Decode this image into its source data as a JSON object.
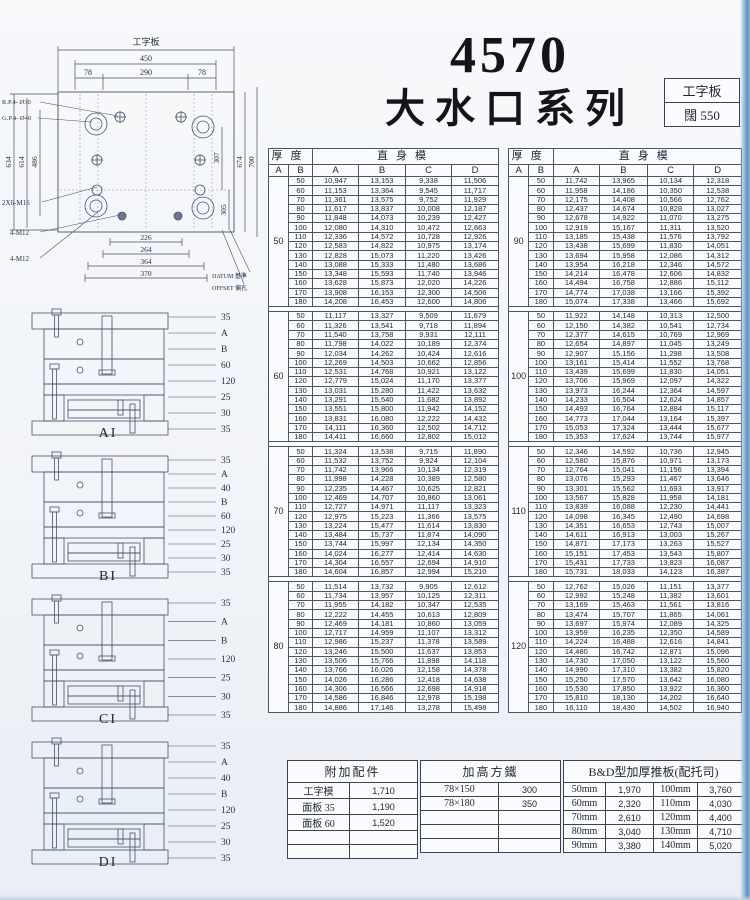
{
  "page": {
    "title": "4570",
    "subtitle": "大水口系列"
  },
  "spec_box": {
    "line1": "工字板",
    "line2_label": "闊",
    "line2_value": "550"
  },
  "drawing": {
    "plate_label": "工字板",
    "dim_450": "450",
    "dim_78l": "78",
    "dim_290": "290",
    "dim_78r": "78",
    "rp": "R.P.4- Ø30",
    "gp": "G.P.4- Ø40",
    "dim_634": "634",
    "dim_614": "614",
    "dim_486": "486",
    "dim_307": "307",
    "dim_305": "305",
    "dim_674": "674",
    "dim_700": "700",
    "m16": "2X6-M16",
    "m12a": "4-M12",
    "m12b": "4-M12",
    "dim_226": "226",
    "dim_264": "264",
    "dim_364": "364",
    "dim_370": "370",
    "datum": "DATUM 基準",
    "offset": "OFFSET 偏孔"
  },
  "diagrams": [
    {
      "label": "AI",
      "dims": [
        "35",
        "A",
        "B",
        "60",
        "120",
        "25",
        "30",
        "35"
      ]
    },
    {
      "label": "BI",
      "dims": [
        "35",
        "A",
        "40",
        "B",
        "60",
        "120",
        "25",
        "30",
        "35"
      ]
    },
    {
      "label": "CI",
      "dims": [
        "35",
        "A",
        "B",
        "120",
        "25",
        "30",
        "35"
      ]
    },
    {
      "label": "DI",
      "dims": [
        "35",
        "A",
        "40",
        "B",
        "120",
        "25",
        "30",
        "35"
      ]
    }
  ],
  "table_header": {
    "thickness": "厚度",
    "straight": "直身模",
    "col_a": "A",
    "col_b": "B",
    "subcols": [
      "A",
      "B",
      "C",
      "D"
    ]
  },
  "left_table": {
    "blocks": [
      {
        "a": "50",
        "rows": [
          [
            "50",
            "10,947",
            "13,153",
            "9,338",
            "11,506"
          ],
          [
            "60",
            "11,153",
            "13,364",
            "9,545",
            "11,717"
          ],
          [
            "70",
            "11,361",
            "13,575",
            "9,752",
            "11,929"
          ],
          [
            "80",
            "11,617",
            "13,837",
            "10,008",
            "12,187"
          ],
          [
            "90",
            "11,848",
            "14,073",
            "10,239",
            "12,427"
          ],
          [
            "100",
            "12,080",
            "14,310",
            "10,472",
            "12,663"
          ],
          [
            "110",
            "12,336",
            "14,572",
            "10,728",
            "12,926"
          ],
          [
            "120",
            "12,583",
            "14,822",
            "10,975",
            "13,174"
          ],
          [
            "130",
            "12,828",
            "15,073",
            "11,220",
            "13,426"
          ],
          [
            "140",
            "13,088",
            "15,333",
            "11,480",
            "13,686"
          ],
          [
            "150",
            "13,348",
            "15,593",
            "11,740",
            "13,946"
          ],
          [
            "160",
            "13,628",
            "15,873",
            "12,020",
            "14,226"
          ],
          [
            "170",
            "13,908",
            "16,153",
            "12,300",
            "14,506"
          ],
          [
            "180",
            "14,208",
            "16,453",
            "12,600",
            "14,806"
          ]
        ]
      },
      {
        "a": "60",
        "rows": [
          [
            "50",
            "11,117",
            "13,327",
            "9,509",
            "11,679"
          ],
          [
            "60",
            "11,326",
            "13,541",
            "9,718",
            "11,894"
          ],
          [
            "70",
            "11,540",
            "13,758",
            "9,931",
            "12,111"
          ],
          [
            "80",
            "11,798",
            "14,022",
            "10,189",
            "12,374"
          ],
          [
            "90",
            "12,034",
            "14,262",
            "10,424",
            "12,616"
          ],
          [
            "100",
            "12,269",
            "14,503",
            "10,662",
            "12,856"
          ],
          [
            "110",
            "12,531",
            "14,768",
            "10,921",
            "13,122"
          ],
          [
            "120",
            "12,779",
            "15,024",
            "11,170",
            "13,377"
          ],
          [
            "130",
            "13,031",
            "15,280",
            "11,422",
            "13,632"
          ],
          [
            "140",
            "13,291",
            "15,540",
            "11,682",
            "13,892"
          ],
          [
            "150",
            "13,551",
            "15,800",
            "11,942",
            "14,152"
          ],
          [
            "160",
            "13,831",
            "16,080",
            "12,222",
            "14,432"
          ],
          [
            "170",
            "14,111",
            "16,360",
            "12,502",
            "14,712"
          ],
          [
            "180",
            "14,411",
            "16,660",
            "12,802",
            "15,012"
          ]
        ]
      },
      {
        "a": "70",
        "rows": [
          [
            "50",
            "11,324",
            "13,538",
            "9,715",
            "11,890"
          ],
          [
            "60",
            "11,532",
            "13,752",
            "9,924",
            "12,104"
          ],
          [
            "70",
            "11,742",
            "13,966",
            "10,134",
            "12,319"
          ],
          [
            "80",
            "11,998",
            "14,228",
            "10,389",
            "12,580"
          ],
          [
            "90",
            "12,235",
            "14,467",
            "10,625",
            "12,821"
          ],
          [
            "100",
            "12,469",
            "14,707",
            "10,860",
            "13,061"
          ],
          [
            "110",
            "12,727",
            "14,971",
            "11,117",
            "13,323"
          ],
          [
            "120",
            "12,975",
            "15,223",
            "11,366",
            "13,575"
          ],
          [
            "130",
            "13,224",
            "15,477",
            "11,614",
            "13,830"
          ],
          [
            "140",
            "13,484",
            "15,737",
            "11,874",
            "14,090"
          ],
          [
            "150",
            "13,744",
            "15,997",
            "12,134",
            "14,350"
          ],
          [
            "160",
            "14,024",
            "16,277",
            "12,414",
            "14,630"
          ],
          [
            "170",
            "14,304",
            "16,557",
            "12,694",
            "14,910"
          ],
          [
            "180",
            "14,604",
            "16,857",
            "12,994",
            "15,210"
          ]
        ]
      },
      {
        "a": "80",
        "rows": [
          [
            "50",
            "11,514",
            "13,732",
            "9,905",
            "12,612"
          ],
          [
            "60",
            "11,734",
            "13,957",
            "10,125",
            "12,311"
          ],
          [
            "70",
            "11,955",
            "14,182",
            "10,347",
            "12,535"
          ],
          [
            "80",
            "12,222",
            "14,455",
            "10,613",
            "12,809"
          ],
          [
            "90",
            "12,469",
            "14,181",
            "10,860",
            "13,059"
          ],
          [
            "100",
            "12,717",
            "14,959",
            "11,107",
            "13,312"
          ],
          [
            "110",
            "12,986",
            "15,237",
            "11,378",
            "13,589"
          ],
          [
            "120",
            "13,246",
            "15,500",
            "11,637",
            "13,853"
          ],
          [
            "130",
            "13,506",
            "15,766",
            "11,898",
            "14,118"
          ],
          [
            "140",
            "13,766",
            "16,026",
            "12,158",
            "14,378"
          ],
          [
            "150",
            "14,026",
            "16,286",
            "12,418",
            "14,638"
          ],
          [
            "160",
            "14,306",
            "16,566",
            "12,698",
            "14,918"
          ],
          [
            "170",
            "14,586",
            "16,846",
            "12,978",
            "15,198"
          ],
          [
            "180",
            "14,886",
            "17,146",
            "13,278",
            "15,498"
          ]
        ]
      }
    ]
  },
  "right_table": {
    "blocks": [
      {
        "a": "90",
        "rows": [
          [
            "50",
            "11,742",
            "13,965",
            "10,134",
            "12,318"
          ],
          [
            "60",
            "11,958",
            "14,186",
            "10,350",
            "12,538"
          ],
          [
            "70",
            "12,175",
            "14,408",
            "10,566",
            "12,762"
          ],
          [
            "80",
            "12,437",
            "14,674",
            "10,828",
            "13,027"
          ],
          [
            "90",
            "12,678",
            "14,922",
            "11,070",
            "13,275"
          ],
          [
            "100",
            "12,919",
            "15,167",
            "11,311",
            "13,520"
          ],
          [
            "110",
            "13,185",
            "15,438",
            "11,576",
            "13,792"
          ],
          [
            "120",
            "13,438",
            "15,699",
            "11,830",
            "14,051"
          ],
          [
            "130",
            "13,694",
            "15,958",
            "12,086",
            "14,312"
          ],
          [
            "140",
            "13,954",
            "16,218",
            "12,346",
            "14,572"
          ],
          [
            "150",
            "14,214",
            "16,478",
            "12,606",
            "14,832"
          ],
          [
            "160",
            "14,494",
            "16,758",
            "12,886",
            "15,112"
          ],
          [
            "170",
            "14,774",
            "17,038",
            "13,166",
            "15,392"
          ],
          [
            "180",
            "15,074",
            "17,338",
            "13,466",
            "15,692"
          ]
        ]
      },
      {
        "a": "100",
        "rows": [
          [
            "50",
            "11,922",
            "14,148",
            "10,313",
            "12,500"
          ],
          [
            "60",
            "12,150",
            "14,382",
            "10,541",
            "12,734"
          ],
          [
            "70",
            "12,377",
            "14,615",
            "10,769",
            "12,969"
          ],
          [
            "80",
            "12,654",
            "14,897",
            "11,045",
            "13,249"
          ],
          [
            "90",
            "12,907",
            "15,156",
            "11,298",
            "13,508"
          ],
          [
            "100",
            "13,161",
            "15,414",
            "11,552",
            "13,768"
          ],
          [
            "110",
            "13,439",
            "15,699",
            "11,830",
            "14,051"
          ],
          [
            "120",
            "13,706",
            "15,969",
            "12,097",
            "14,322"
          ],
          [
            "130",
            "13,973",
            "16,244",
            "12,364",
            "14,597"
          ],
          [
            "140",
            "14,233",
            "16,504",
            "12,624",
            "14,857"
          ],
          [
            "150",
            "14,493",
            "16,764",
            "12,884",
            "15,117"
          ],
          [
            "160",
            "14,773",
            "17,044",
            "13,164",
            "15,397"
          ],
          [
            "170",
            "15,053",
            "17,324",
            "13,444",
            "15,677"
          ],
          [
            "180",
            "15,353",
            "17,624",
            "13,744",
            "15,977"
          ]
        ]
      },
      {
        "a": "110",
        "rows": [
          [
            "50",
            "12,346",
            "14,592",
            "10,736",
            "12,945"
          ],
          [
            "60",
            "12,580",
            "15,876",
            "10,971",
            "13,173"
          ],
          [
            "70",
            "12,764",
            "15,041",
            "11,156",
            "13,394"
          ],
          [
            "80",
            "13,076",
            "15,293",
            "11,467",
            "13,646"
          ],
          [
            "90",
            "13,301",
            "15,562",
            "11,693",
            "13,917"
          ],
          [
            "100",
            "13,567",
            "15,828",
            "11,958",
            "14,181"
          ],
          [
            "110",
            "13,839",
            "16,088",
            "12,230",
            "14,441"
          ],
          [
            "120",
            "14,098",
            "16,345",
            "12,490",
            "14,698"
          ],
          [
            "130",
            "14,351",
            "16,653",
            "12,743",
            "15,007"
          ],
          [
            "140",
            "14,611",
            "16,913",
            "13,003",
            "15,267"
          ],
          [
            "150",
            "14,871",
            "17,173",
            "13,263",
            "15,527"
          ],
          [
            "160",
            "15,151",
            "17,453",
            "13,543",
            "15,807"
          ],
          [
            "170",
            "15,431",
            "17,733",
            "13,823",
            "16,087"
          ],
          [
            "180",
            "15,731",
            "18,033",
            "14,123",
            "16,387"
          ]
        ]
      },
      {
        "a": "120",
        "rows": [
          [
            "50",
            "12,762",
            "15,026",
            "11,151",
            "13,377"
          ],
          [
            "60",
            "12,992",
            "15,248",
            "11,382",
            "13,601"
          ],
          [
            "70",
            "13,169",
            "15,463",
            "11,561",
            "13,816"
          ],
          [
            "80",
            "13,474",
            "15,707",
            "11,865",
            "14,061"
          ],
          [
            "90",
            "13,697",
            "15,974",
            "12,089",
            "14,325"
          ],
          [
            "100",
            "13,959",
            "16,235",
            "12,350",
            "14,589"
          ],
          [
            "110",
            "14,224",
            "16,488",
            "12,616",
            "14,841"
          ],
          [
            "120",
            "14,480",
            "16,742",
            "12,871",
            "15,096"
          ],
          [
            "130",
            "14,730",
            "17,050",
            "13,122",
            "15,560"
          ],
          [
            "140",
            "14,990",
            "17,310",
            "13,382",
            "15,820"
          ],
          [
            "150",
            "15,250",
            "17,570",
            "13,642",
            "16,080"
          ],
          [
            "160",
            "15,530",
            "17,850",
            "13,922",
            "16,360"
          ],
          [
            "170",
            "15,810",
            "18,130",
            "14,202",
            "16,640"
          ],
          [
            "180",
            "16,110",
            "18,430",
            "14,502",
            "16,940"
          ]
        ]
      }
    ]
  },
  "bottom": {
    "extras": {
      "title": "附加配件",
      "rows": [
        [
          "工字模",
          "1,710"
        ],
        [
          "面板 35",
          "1,190"
        ],
        [
          "面板 60",
          "1,520"
        ],
        [
          "",
          ""
        ],
        [
          "",
          ""
        ]
      ]
    },
    "risers": {
      "title": "加高方鐵",
      "rows": [
        [
          "78×150",
          "300"
        ],
        [
          "78×180",
          "350"
        ],
        [
          "",
          ""
        ],
        [
          "",
          ""
        ],
        [
          "",
          ""
        ]
      ]
    },
    "bd": {
      "title": "B&D型加厚推板(配托司)",
      "rows": [
        [
          "50mm",
          "1,970",
          "100mm",
          "3,760"
        ],
        [
          "60mm",
          "2,320",
          "110mm",
          "4,030"
        ],
        [
          "70mm",
          "2,610",
          "120mm",
          "4,400"
        ],
        [
          "80mm",
          "3,040",
          "130mm",
          "4,710"
        ],
        [
          "90mm",
          "3,380",
          "140mm",
          "5,020"
        ]
      ]
    }
  }
}
